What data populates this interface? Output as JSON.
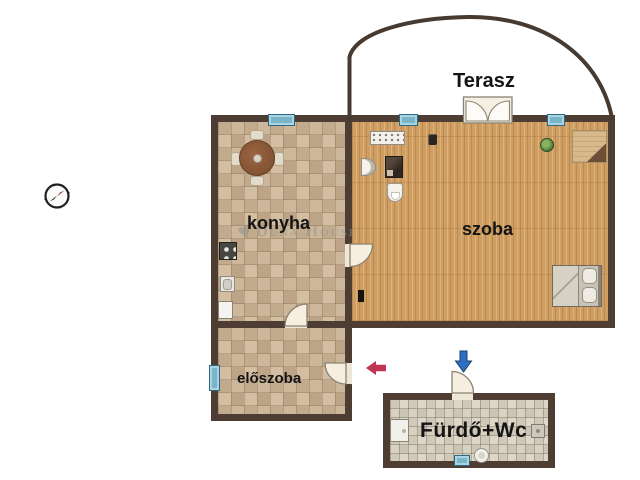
{
  "plan": {
    "title": "apartment-floor-plan",
    "rooms": {
      "terasz": {
        "label": "Terasz"
      },
      "konyha": {
        "label": "konyha"
      },
      "szoba": {
        "label": "szoba"
      },
      "eloszoba": {
        "label": "előszoba"
      },
      "furdo_wc": {
        "label": "Fürdő+Wc"
      }
    },
    "watermark": {
      "text": "Duna House",
      "icon": "heart-icon"
    },
    "icons": {
      "compass": "compass-icon",
      "entry_arrow": "left-arrow-icon",
      "bathroom_arrow": "down-arrow-icon"
    },
    "colors": {
      "wall": "#4e3d33",
      "wood_floor": "#cf9e62",
      "tile_floor": "#c7b194",
      "bath_floor": "#d7d1c2",
      "window": "#7ab4c8",
      "door_leaf": "#f6efdf",
      "entry_arrow": "#c23453",
      "bathroom_arrow": "#2d6fc2",
      "label_text": "#141414"
    }
  }
}
